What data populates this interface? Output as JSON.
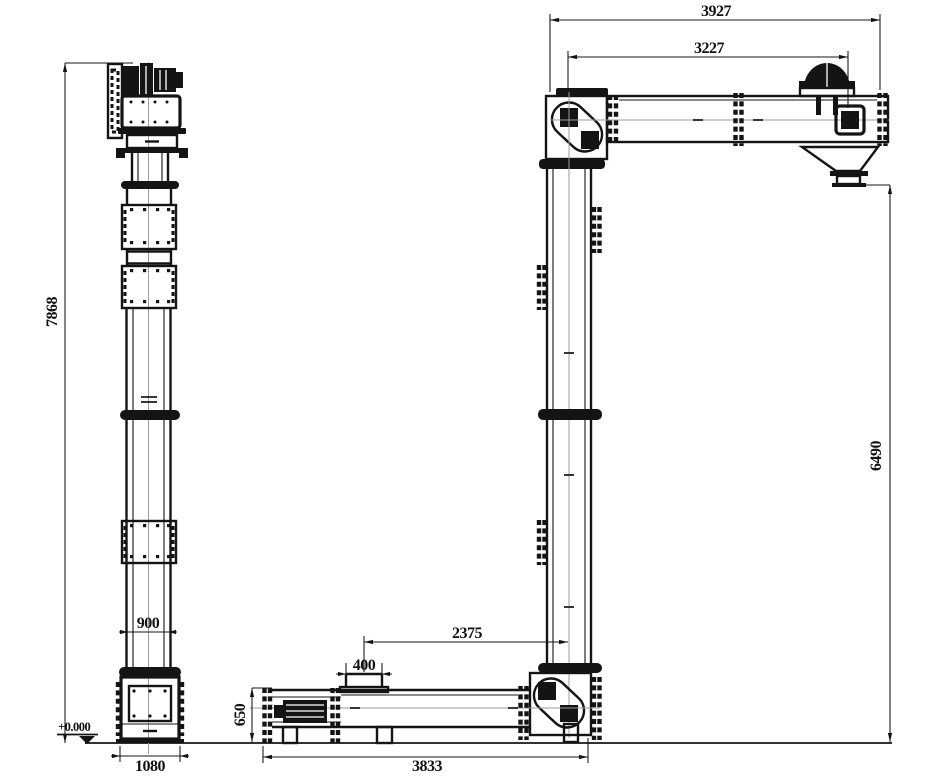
{
  "drawing": {
    "type": "technical-elevation-drawing",
    "subject": "z-type-bucket-elevator-general-arrangement",
    "colors": {
      "background": "#ffffff",
      "lines": "#141414",
      "centerline": "#9c9c9c"
    },
    "dimensions": {
      "left_total_height": "7868",
      "top_overall_length": "3927",
      "top_head_distance": "3227",
      "right_drop_height": "6490",
      "left_column_width": "900",
      "left_base_width": "1080",
      "inlet_to_leg_distance": "2375",
      "inlet_width": "400",
      "boot_height": "650",
      "bottom_overall_length": "3833",
      "ground_level": "+0.000"
    }
  }
}
